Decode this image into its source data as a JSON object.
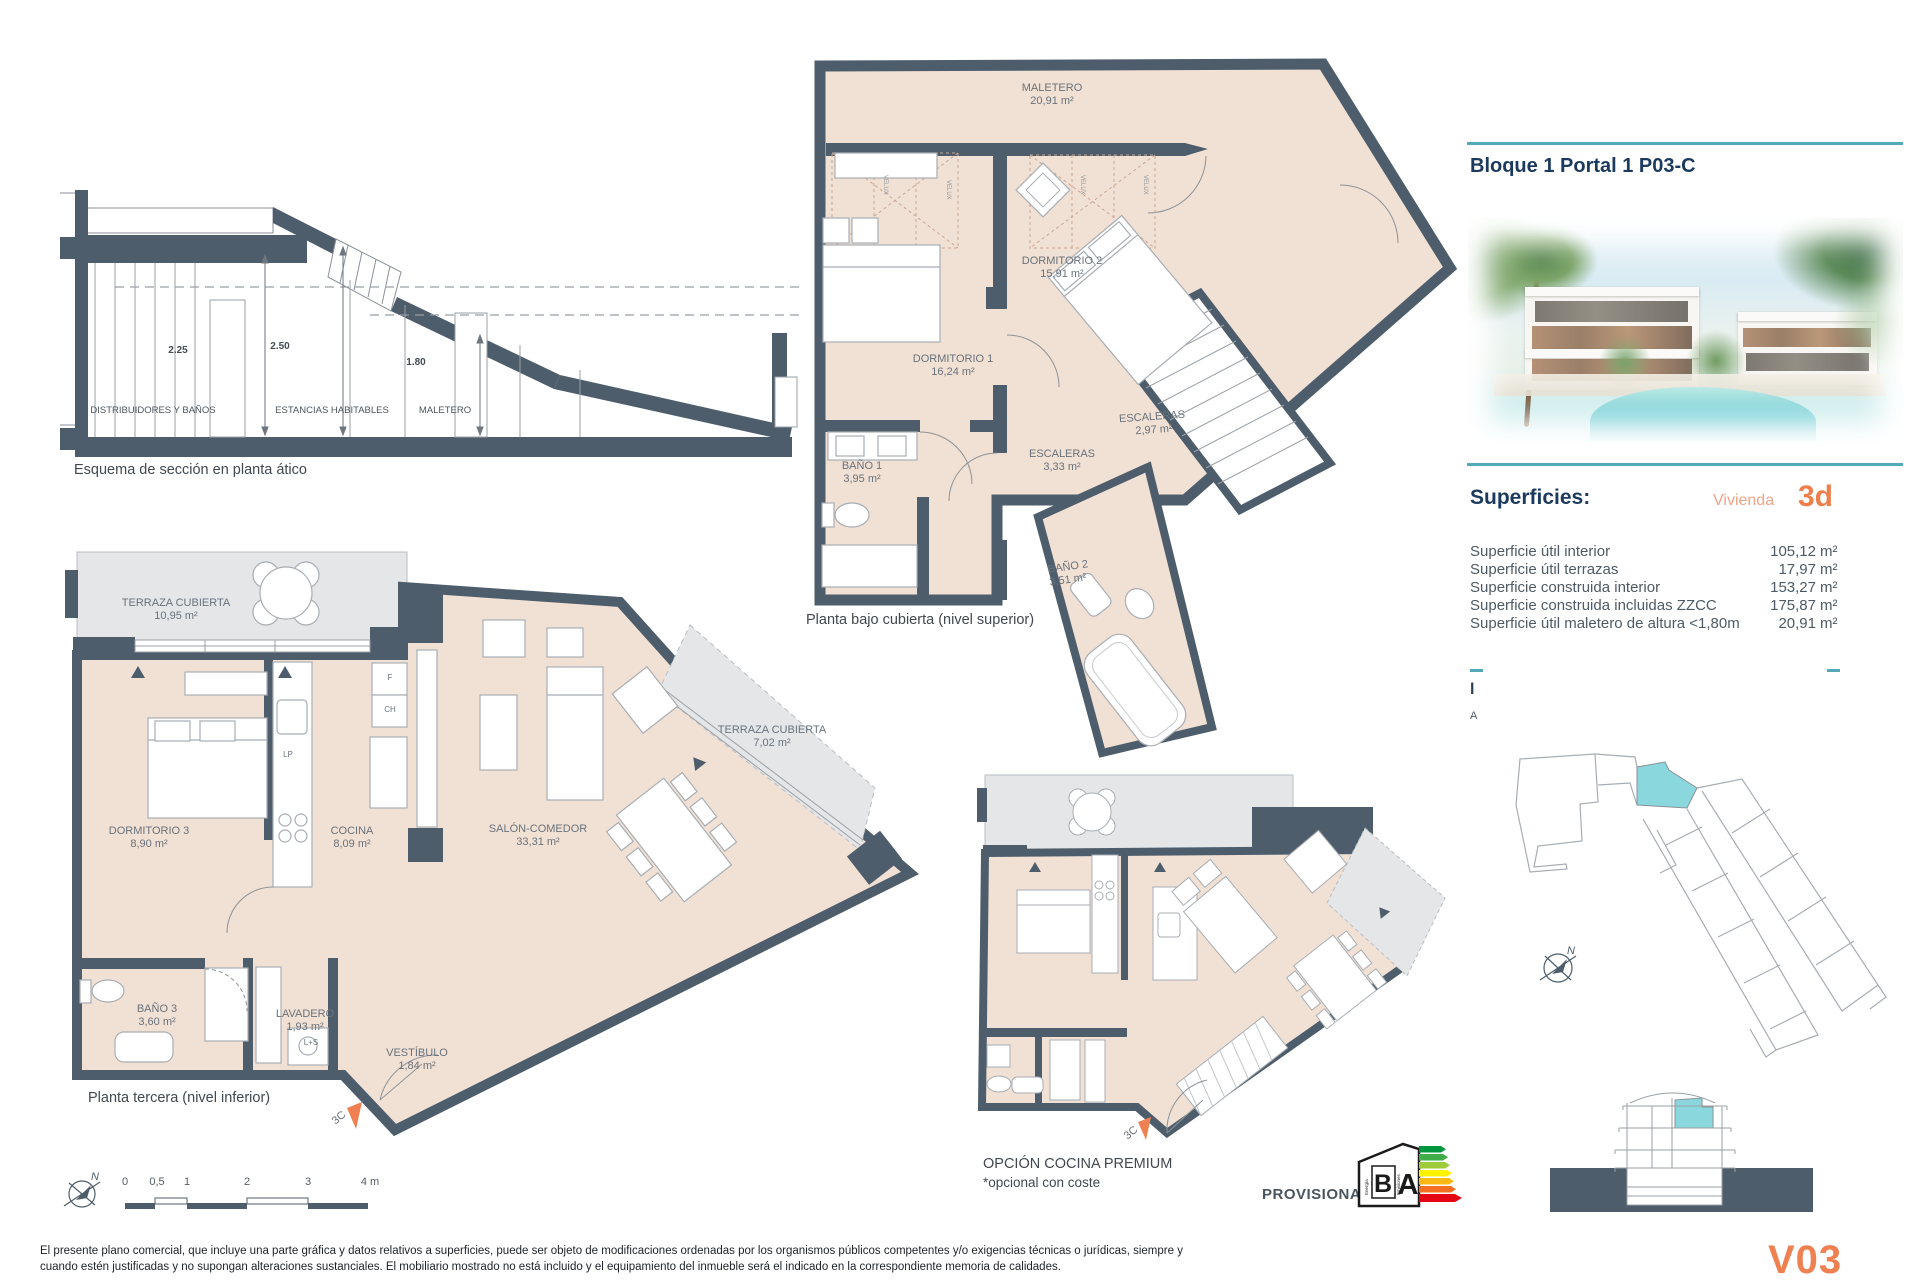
{
  "colors": {
    "wall": "#4d5d6b",
    "floor": "#f1e0d4",
    "terrace": "#e4e6e8",
    "teal": "#53a9b7",
    "navy": "#1c3a5e",
    "orange": "#ee7f4b",
    "orange_light": "#f2a488",
    "highlight_cyan": "#8ad8de"
  },
  "section_schema": {
    "caption": "Esquema de sección en planta ático",
    "dim_left": "2.25",
    "dim_mid": "2.50",
    "dim_right": "1.80",
    "zone_1": "DISTRIBUIDORES Y BAÑOS",
    "zone_2": "ESTANCIAS HABITABLES",
    "zone_3": "MALETERO"
  },
  "plan_upper": {
    "caption": "Planta bajo cubierta (nivel superior)",
    "maletero_name": "MALETERO",
    "maletero_area": "20,91 m²",
    "dorm1_name": "DORMITORIO 1",
    "dorm1_area": "16,24 m²",
    "dorm2_name": "DORMITORIO 2",
    "dorm2_area": "15,91 m²",
    "bano1_name": "BAÑO 1",
    "bano1_area": "3,95 m²",
    "esc1_name": "ESCALERAS",
    "esc1_area": "3,33 m²",
    "esc2_name": "ESCALERAS",
    "esc2_area": "2,97 m²",
    "bano2_name": "BAÑO 2",
    "bano2_area": "3,51 m²",
    "velux": "VELUX"
  },
  "plan_lower": {
    "caption": "Planta tercera (nivel inferior)",
    "terraza1_name": "TERRAZA CUBIERTA",
    "terraza1_area": "10,95 m²",
    "dorm3_name": "DORMITORIO 3",
    "dorm3_area": "8,90 m²",
    "cocina_name": "COCINA",
    "cocina_area": "8,09 m²",
    "salon_name": "SALÓN-COMEDOR",
    "salon_area": "33,31 m²",
    "terraza2_name": "TERRAZA CUBIERTA",
    "terraza2_area": "7,02 m²",
    "bano3_name": "BAÑO 3",
    "bano3_area": "3,60 m²",
    "lavadero_name": "LAVADERO",
    "lavadero_area": "1,93 m²",
    "ls_label": "L+S",
    "vestibulo_name": "VESTÍBULO",
    "vestibulo_area": "1,84 m²",
    "f_label": "F",
    "ch_label": "CH",
    "lp_label": "LP",
    "unit_marker": "3C"
  },
  "plan_premium": {
    "caption": "OPCIÓN COCINA PREMIUM",
    "note": "*opcional con coste",
    "unit_marker": "3C"
  },
  "scalebar": {
    "north": "N",
    "ticks": [
      "0",
      "0,5",
      "1",
      "2",
      "3",
      "4 m"
    ]
  },
  "panel": {
    "title": "Bloque 1 Portal 1 P03-C",
    "superficies_title": "Superficies:",
    "vivienda_label": "Vivienda",
    "vivienda_code": "3d",
    "rows": [
      {
        "label": "Superficie útil interior",
        "value": "105,12",
        "unit": "m²"
      },
      {
        "label": "Superficie útil terrazas",
        "value": "17,97",
        "unit": "m²"
      },
      {
        "label": "Superficie construida interior",
        "value": "153,27",
        "unit": "m²"
      },
      {
        "label": "Superficie construida incluidas ZZCC",
        "value": "175,87",
        "unit": "m²"
      },
      {
        "label": "Superficie útil maletero de altura <1,80m",
        "value": "20,91",
        "unit": "m²"
      }
    ],
    "cut_line_1": "l",
    "cut_line_2": "A",
    "north": "N",
    "version": "V03"
  },
  "energy": {
    "provisional": "PROVISIONAL",
    "letter_b": "B",
    "letter_a": "A",
    "energia": "Energía",
    "emisiones": "Emisiones",
    "scale_colors": [
      "#009640",
      "#3fae49",
      "#9dcb3b",
      "#fff200",
      "#fdb913",
      "#f36f21",
      "#e30613"
    ]
  },
  "footer": {
    "line1": "El presente plano comercial, que incluye una parte gráfica y datos relativos a superficies, puede ser objeto de modificaciones ordenadas por los organismos públicos competentes y/o exigencias técnicas o jurídicas, siempre y",
    "line2": "cuando estén justificadas y no supongan alteraciones sustanciales. El mobiliario mostrado no está incluido y el equipamiento del inmueble será el indicado en la correspondiente memoria de calidades."
  }
}
